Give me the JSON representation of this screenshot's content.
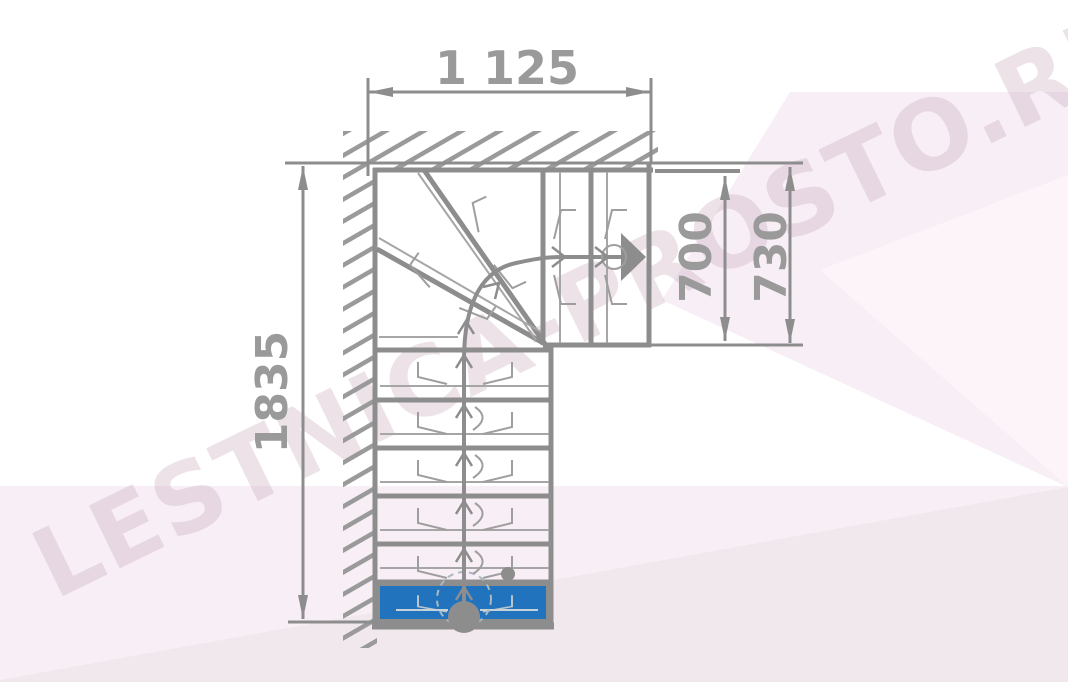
{
  "watermark": {
    "text": "LESTNICA-PROSTO.RU"
  },
  "colors": {
    "line": "#8d8d8d",
    "thin_line": "#a6a6a6",
    "decor_line": "#9e9e9e",
    "label_text": "#9a9a9a",
    "first_step": "#2273be",
    "first_step_decor": "#b9c6cd",
    "wall_hatch": "#9a9a9a",
    "background_pink": "#f8eef5",
    "background_wedge": "#f1e8ee",
    "watermark_color": "#c9afc0"
  },
  "dimensions": {
    "top_width": {
      "label": "1 125"
    },
    "inner_height": {
      "label": "700"
    },
    "outer_height": {
      "label": "730"
    },
    "total_length": {
      "label": "1835"
    }
  },
  "plan": {
    "type": "L-shaped staircase with winder turn (top view)",
    "first_step_highlighted": true,
    "direction_arrow": "right",
    "lower_flight_treads": 7,
    "upper_flight_treads": 3
  }
}
